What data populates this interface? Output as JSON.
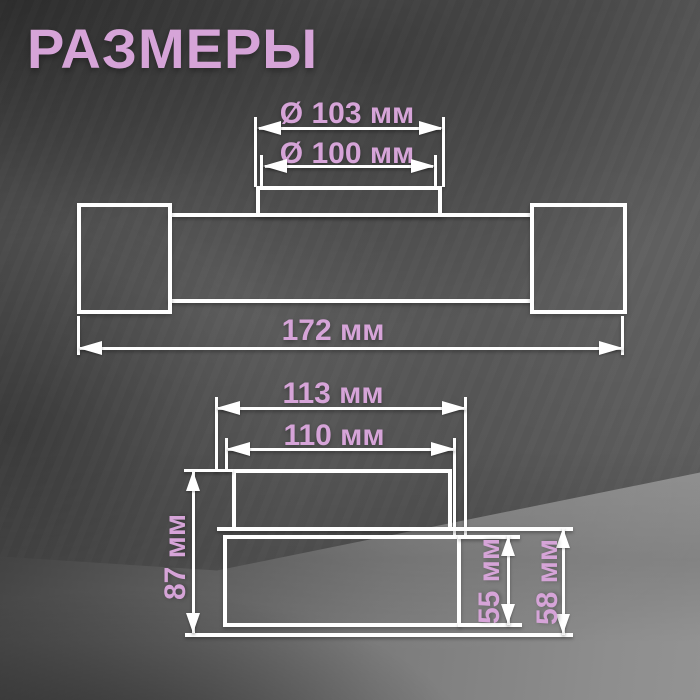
{
  "title": "РАЗМЕРЫ",
  "units": "мм",
  "colors": {
    "accent_pink": "#d6a4d8",
    "line_white": "#ffffff",
    "wall_gray": "#545454",
    "floor_gray": "#8e8e8e"
  },
  "front_view": {
    "dim_canopy_outer": {
      "label": "Ø 103 мм",
      "value_mm": 103
    },
    "dim_canopy_inner": {
      "label": "Ø 100 мм",
      "value_mm": 100
    },
    "dim_total_width": {
      "label": "172 мм",
      "value_mm": 172
    }
  },
  "side_view": {
    "dim_base_width": {
      "label": "113 мм",
      "value_mm": 113
    },
    "dim_canopy_width": {
      "label": "110 мм",
      "value_mm": 110
    },
    "dim_total_height": {
      "label": "87 мм",
      "value_mm": 87
    },
    "dim_shade_height": {
      "label": "55 мм",
      "value_mm": 55
    },
    "dim_body_height": {
      "label": "58 мм",
      "value_mm": 58
    }
  }
}
